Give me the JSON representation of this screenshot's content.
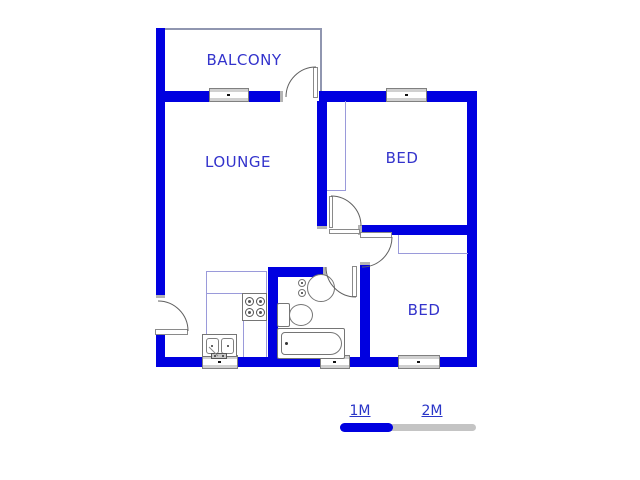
{
  "plan": {
    "title": "2-bedroom apartment floor plan",
    "rooms": {
      "balcony": {
        "label": "BALCONY"
      },
      "lounge": {
        "label": "LOUNGE"
      },
      "bed1": {
        "label": "BED"
      },
      "bed2": {
        "label": "BED"
      }
    },
    "scale": {
      "segments": [
        {
          "label": "1M",
          "color": "#0000e0"
        },
        {
          "label": "2M",
          "color": "#c4c4c4"
        }
      ]
    },
    "fixtures": [
      "kitchen-counter",
      "stove",
      "double-sink",
      "wash-basin",
      "toilet",
      "bathtub",
      "closet-bed1",
      "closet-bed2"
    ],
    "windows_count": 5,
    "doors_count": 5,
    "colors": {
      "wall": "#0000e0",
      "room_label": "#3333cc",
      "fixture_outline": "#757575",
      "counter_outline": "#9a9ada",
      "window_band": "#d0d0d0",
      "scale_gray": "#c4c4c4"
    }
  }
}
